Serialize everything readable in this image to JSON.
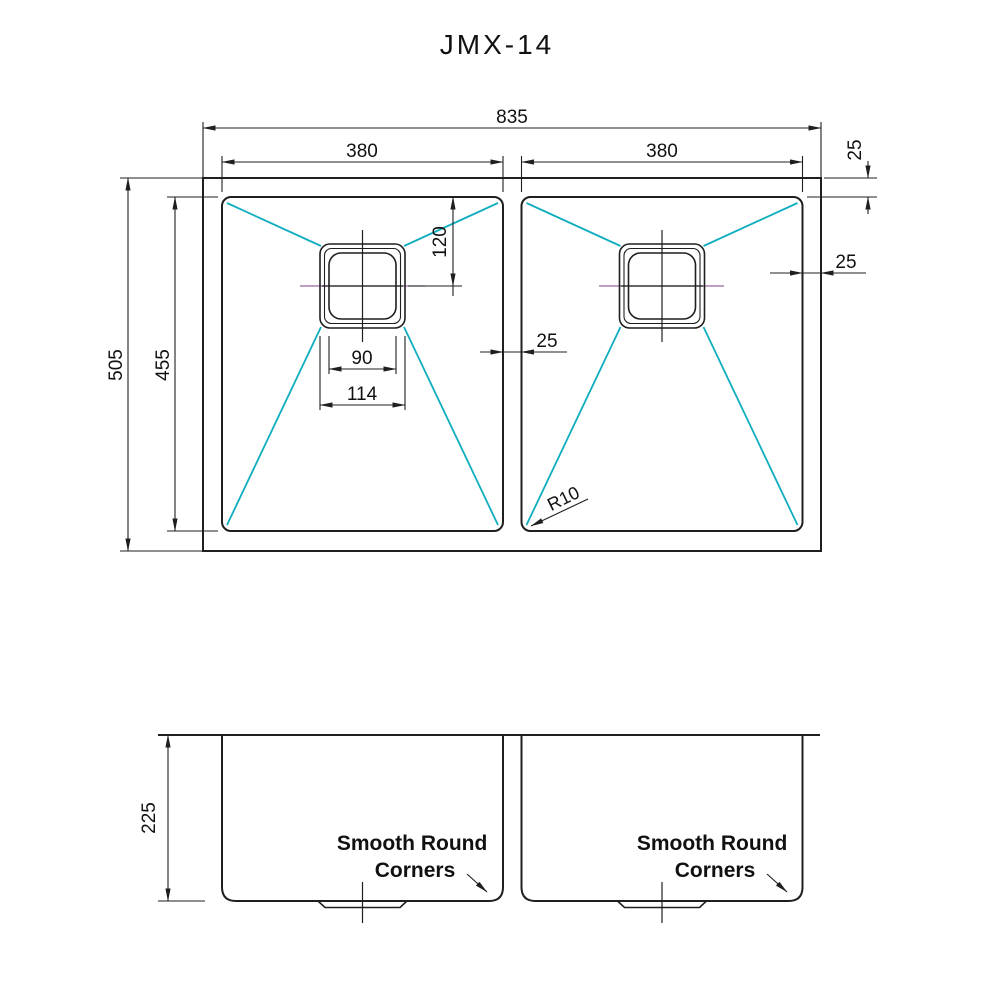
{
  "title": "JMX-14",
  "colors": {
    "line": "#1f1f1f",
    "slope_lines": "#0FAEBE",
    "centerline": "#9c64a8"
  },
  "top_view": {
    "overall_width": "835",
    "bowl_width_left": "380",
    "bowl_width_right": "380",
    "overall_depth": "505",
    "bowl_depth": "455",
    "drain_offset_from_top": "120",
    "drain_inner_width": "90",
    "drain_outer_width": "114",
    "divider_width": "25",
    "rim_side_width": "25",
    "rim_top_width": "25",
    "corner_radius_label": "R10"
  },
  "front_view": {
    "bowl_height": "225",
    "note_line1": "Smooth Round",
    "note_line2": "Corners"
  }
}
